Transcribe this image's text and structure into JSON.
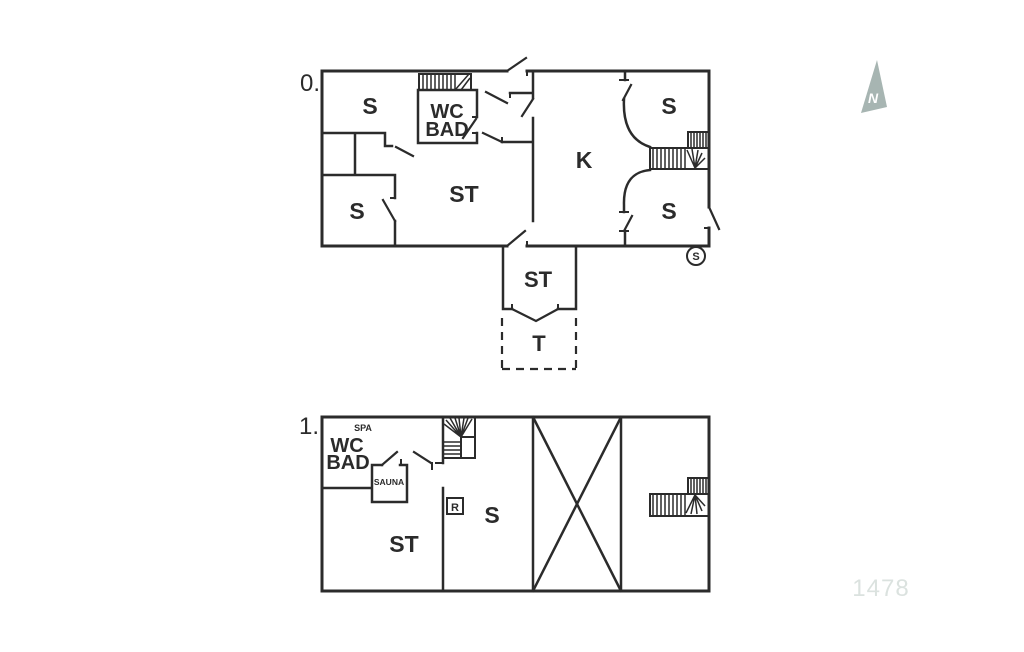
{
  "floor0": {
    "label": "0.",
    "rooms": {
      "s_top_left": "S",
      "wc_line1": "WC",
      "wc_line2": "BAD",
      "st": "ST",
      "k": "K",
      "s_top_right": "S",
      "s_bottom_right": "S",
      "s_bottom_left": "S"
    },
    "entry": {
      "st": "ST"
    },
    "terrace": {
      "t": "T"
    },
    "spiral_marker": "S"
  },
  "floor1": {
    "label": "1.",
    "rooms": {
      "spa": "SPA",
      "wc_line1": "WC",
      "wc_line2": "BAD",
      "sauna": "SAUNA",
      "st": "ST",
      "s": "S",
      "r": "R"
    }
  },
  "compass": {
    "north": "N"
  },
  "plan_number": "1478",
  "colors": {
    "line": "#2b2b2b",
    "compass_fill": "#a7b5b2",
    "plan_number_color": "#dbe2df",
    "background": "#ffffff"
  }
}
